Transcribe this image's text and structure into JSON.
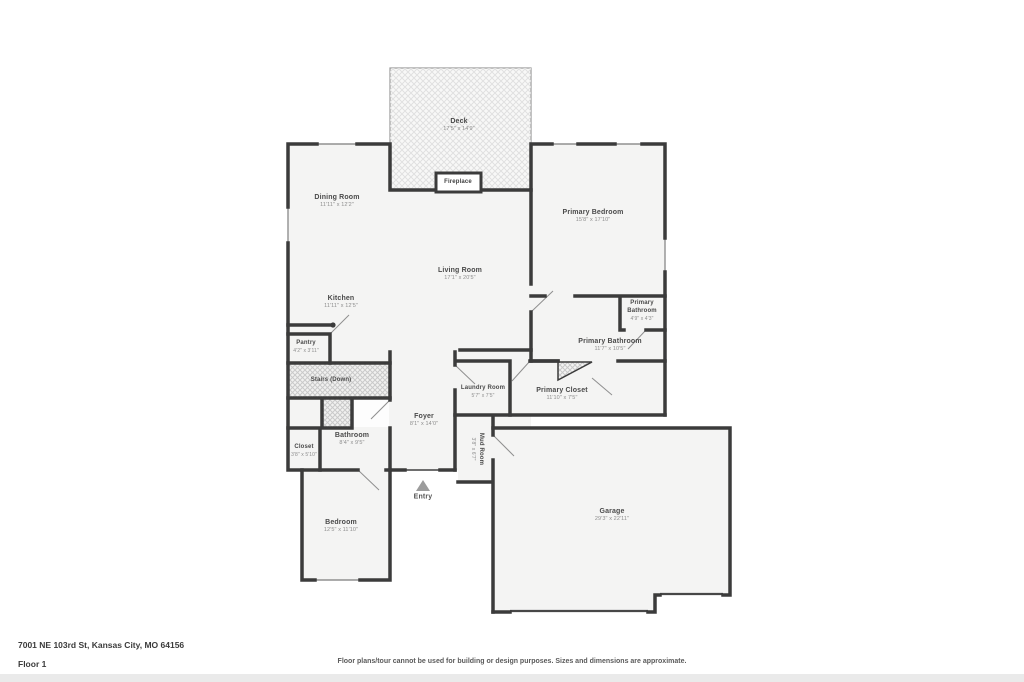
{
  "footer": {
    "address": "7001 NE 103rd St, Kansas City, MO 64156",
    "floor_label": "Floor 1",
    "disclaimer": "Floor plans/tour cannot be used for building or design purposes. Sizes and dimensions are approximate."
  },
  "rooms": {
    "deck": {
      "name": "Deck",
      "dims": "17'5\" x 14'9\""
    },
    "fireplace": {
      "name": "Fireplace"
    },
    "dining_room": {
      "name": "Dining Room",
      "dims": "11'11\" x 12'2\""
    },
    "primary_bedroom": {
      "name": "Primary Bedroom",
      "dims": "15'8\" x 17'10\""
    },
    "living_room": {
      "name": "Living Room",
      "dims": "17'1\" x 20'5\""
    },
    "kitchen": {
      "name": "Kitchen",
      "dims": "11'11\" x 12'5\""
    },
    "pantry": {
      "name": "Pantry",
      "dims": "4'2\" x 3'11\""
    },
    "stairs": {
      "name": "Stairs (Down)"
    },
    "primary_bathroom_small": {
      "name": "Primary Bathroom",
      "dims": "4'9\" x 4'3\""
    },
    "primary_bathroom": {
      "name": "Primary Bathroom",
      "dims": "11'7\" x 10'5\""
    },
    "laundry_room": {
      "name": "Laundry Room",
      "dims": "5'7\" x 7'5\""
    },
    "primary_closet": {
      "name": "Primary Closet",
      "dims": "11'10\" x 7'5\""
    },
    "foyer": {
      "name": "Foyer",
      "dims": "8'1\" x 14'0\""
    },
    "bathroom": {
      "name": "Bathroom",
      "dims": "8'4\" x 9'5\""
    },
    "closet": {
      "name": "Closet",
      "dims": "3'8\" x 5'10\""
    },
    "mud_room": {
      "name": "Mud Room",
      "dims": "3'8\" x 6'7\""
    },
    "entry": {
      "name": "Entry"
    },
    "bedroom": {
      "name": "Bedroom",
      "dims": "12'5\" x 11'10\""
    },
    "garage": {
      "name": "Garage",
      "dims": "29'3\" x 22'11\""
    }
  },
  "colors": {
    "wall": "#3b3b3b",
    "room_fill": "#f4f4f3",
    "hatch_line": "#d9d9d9",
    "window_line": "#909090",
    "label_text": "#4a4a4a",
    "dims_text": "#8d8d8d"
  }
}
